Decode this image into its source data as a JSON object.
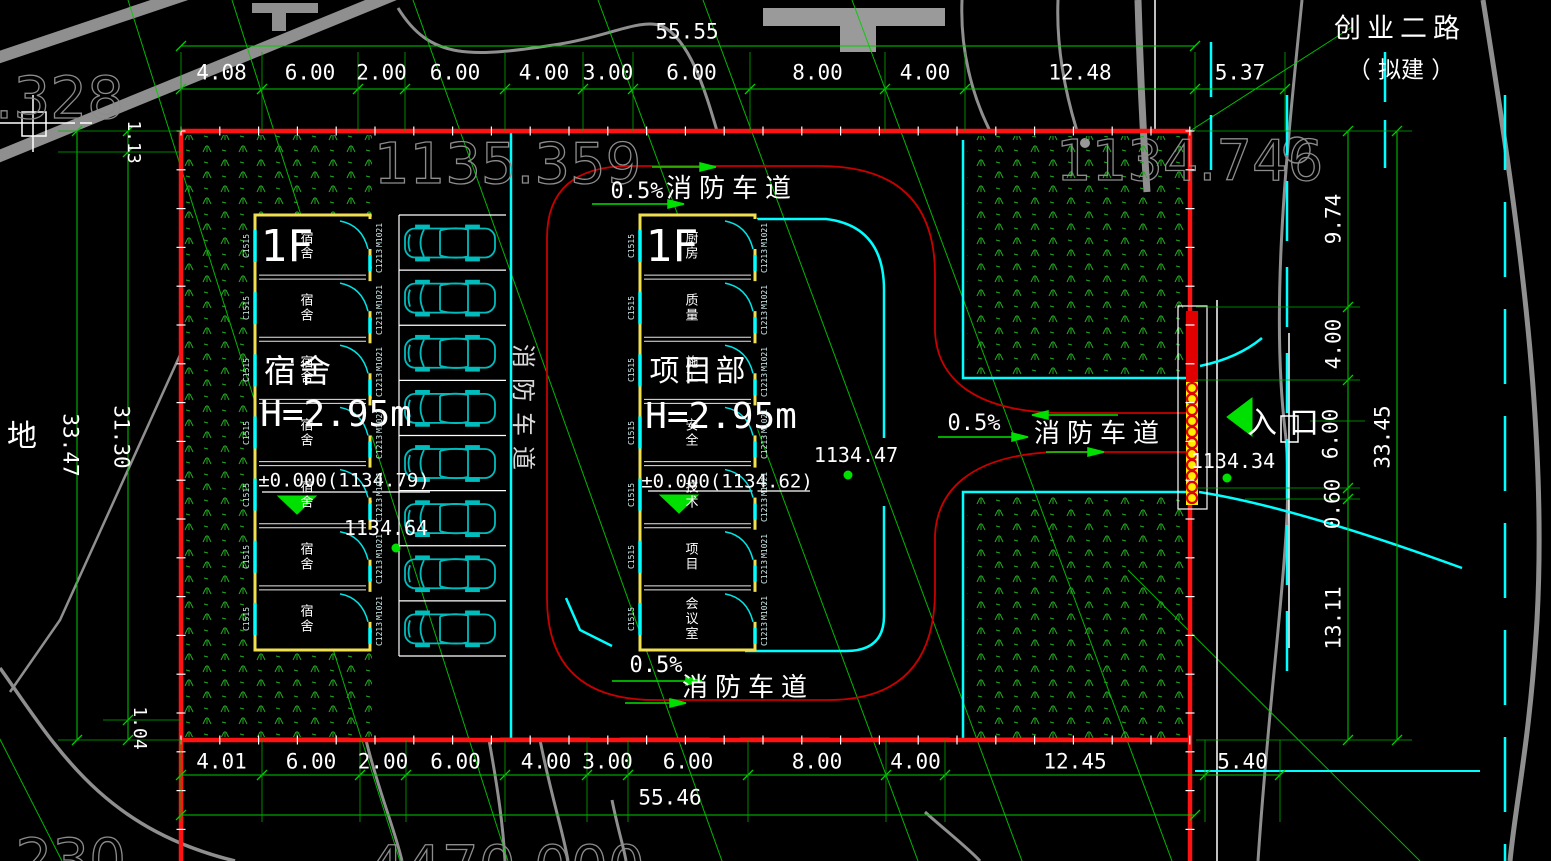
{
  "canvas": {
    "width": 1551,
    "height": 861
  },
  "colors": {
    "background": "#000000",
    "boundary_red": "#ff1212",
    "fire_lane_red": "#c80000",
    "dim_green": "#00cc00",
    "road_cyan": "#00ffff",
    "wall_yellow": "#f0e050",
    "contour_gray": "#8f8f8f",
    "text_white": "#ffffff",
    "car_teal": "#00bdbd",
    "grass_green": "#22aa22",
    "gate_yellow": "#ffee00"
  },
  "road": {
    "name": "创业二路",
    "status": "（ 拟建 ）"
  },
  "west_label": "地",
  "fire_lane": {
    "label": "消防车道",
    "slope": "0.5%"
  },
  "entrance": {
    "label": "入口",
    "spot_elevation": "1134.34"
  },
  "dims": {
    "top": {
      "total": "55.55",
      "segments": [
        "4.08",
        "6.00",
        "2.00",
        "6.00",
        "4.00",
        "3.00",
        "6.00",
        "8.00",
        "4.00",
        "12.48",
        "5.37"
      ]
    },
    "bottom": {
      "total": "55.46",
      "segments": [
        "4.01",
        "6.00",
        "2.00",
        "6.00",
        "4.00",
        "3.00",
        "6.00",
        "8.00",
        "4.00",
        "12.45",
        "5.40"
      ]
    },
    "left": {
      "overall": "33.47",
      "inner": "31.30",
      "top_offset": "1.13",
      "bottom_offset": "1.04"
    },
    "right": {
      "overall": "33.45",
      "segments": [
        "9.74",
        "4.00",
        "6.00",
        "0.60",
        "13.11"
      ]
    }
  },
  "buildings": {
    "dorm": {
      "floor": "1F",
      "name": "宿舍",
      "height": "H=2.95m",
      "level": "±0.000(1134.79)",
      "spot_elevation": "1134.64",
      "rooms": [
        "宿舍",
        "宿舍",
        "宿舍",
        "宿舍",
        "宿舍",
        "宿舍",
        "宿舍"
      ],
      "window_tag": "C1515",
      "door_tag": "M1021",
      "window2_tag": "C1213"
    },
    "office": {
      "floor": "1F",
      "name": "项目部",
      "height": "H=2.95m",
      "level": "±0.000(1134.62)",
      "spot_elevation": "1134.47",
      "rooms": [
        "厨房",
        "质量",
        "施工",
        "安全",
        "技术",
        "项目",
        "会议室"
      ],
      "window_tag": "C1515",
      "door_tag": "M1021",
      "window2_tag": "C1213"
    }
  },
  "contour_labels": {
    "northwest": "5.328",
    "north": "1135.359",
    "northeast": "1134.746",
    "southwest": "5.230",
    "south": "4470.000"
  },
  "parking": {
    "stalls": 8
  }
}
